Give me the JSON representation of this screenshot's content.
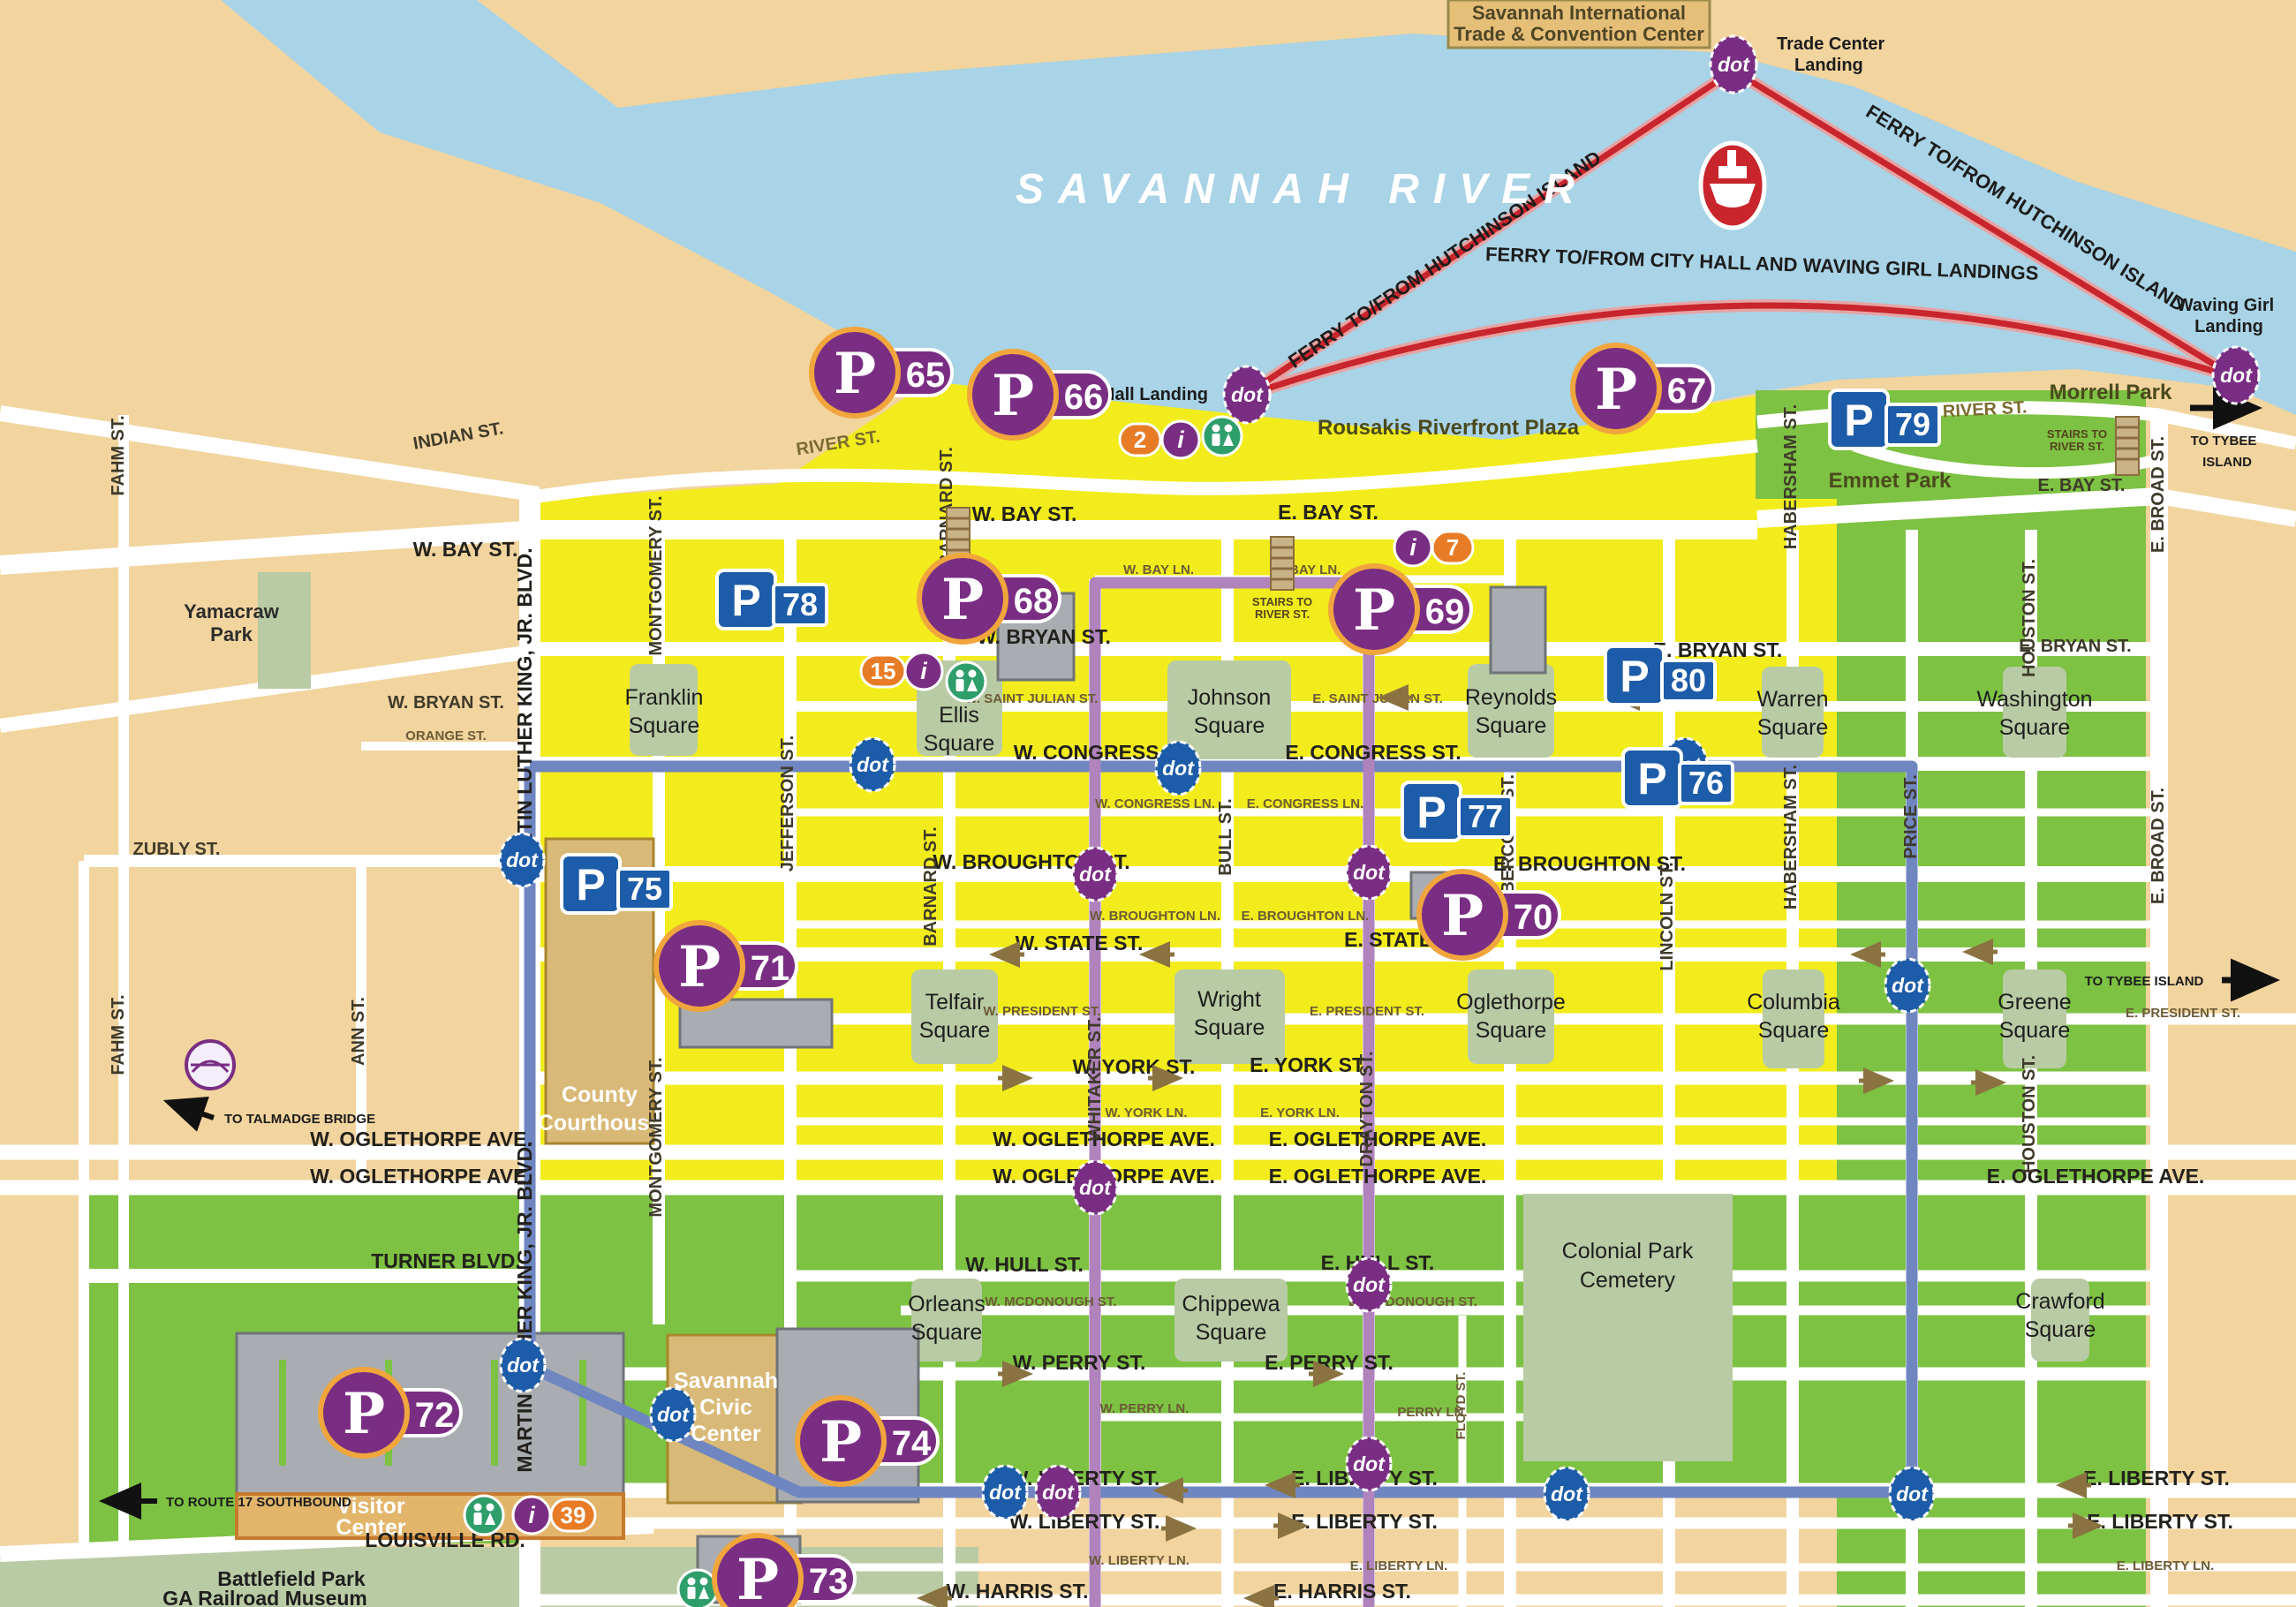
{
  "river": {
    "name": "SAVANNAH RIVER"
  },
  "ferry": {
    "hutchinson_route": "FERRY TO/FROM HUTCHINSON ISLAND",
    "cityhall_route": "FERRY TO/FROM CITY HALL AND WAVING GIRL LANDINGS",
    "trade_center_landing": [
      "Trade Center",
      "Landing"
    ],
    "city_hall_landing": "City Hall Landing",
    "waving_girl_landing": [
      "Waving Girl",
      "Landing"
    ]
  },
  "transit": {
    "dot": "dot"
  },
  "parking": {
    "letter": "P",
    "garages": {
      "p65": "65",
      "p66": "66",
      "p67": "67",
      "p68": "68",
      "p69": "69",
      "p70": "70",
      "p71": "71",
      "p72": "72",
      "p73": "73",
      "p74": "74"
    },
    "lots": {
      "p75": "75",
      "p76": "76",
      "p77": "77",
      "p78": "78",
      "p79": "79",
      "p80": "80"
    }
  },
  "info": {
    "i": "i",
    "n2": "2",
    "n7": "7",
    "n15": "15",
    "n39": "39"
  },
  "places": {
    "convention_center": [
      "Savannah International",
      "Trade & Convention Center"
    ],
    "rousakis": "Rousakis Riverfront Plaza",
    "morrell_park": "Morrell Park",
    "emmet_park": "Emmet Park",
    "yamacraw_park": [
      "Yamacraw",
      "Park"
    ],
    "county_courthouse": [
      "County",
      "Courthouse"
    ],
    "civic_center": [
      "Savannah",
      "Civic",
      "Center"
    ],
    "visitor_center": [
      "Visitor",
      "Center"
    ],
    "cemetery": [
      "Colonial Park",
      "Cemetery"
    ],
    "battlefield_park": "Battlefield Park",
    "ga_railroad_museum": "GA Railroad Museum"
  },
  "squares": {
    "franklin": [
      "Franklin",
      "Square"
    ],
    "ellis": [
      "Ellis",
      "Square"
    ],
    "johnson": [
      "Johnson",
      "Square"
    ],
    "reynolds": [
      "Reynolds",
      "Square"
    ],
    "warren": [
      "Warren",
      "Square"
    ],
    "washington": [
      "Washington",
      "Square"
    ],
    "telfair": [
      "Telfair",
      "Square"
    ],
    "wright": [
      "Wright",
      "Square"
    ],
    "oglethorpe_sq": [
      "Oglethorpe",
      "Square"
    ],
    "columbia": [
      "Columbia",
      "Square"
    ],
    "greene": [
      "Greene",
      "Square"
    ],
    "orleans": [
      "Orleans",
      "Square"
    ],
    "chippewa": [
      "Chippewa",
      "Square"
    ],
    "crawford": [
      "Crawford",
      "Square"
    ]
  },
  "streets": {
    "indian": "INDIAN ST.",
    "fahm": "FAHM ST.",
    "ann": "ANN ST.",
    "river": "RIVER ST.",
    "w_bay": "W. BAY ST.",
    "e_bay": "E. BAY ST.",
    "w_bay_ln": "W. BAY LN.",
    "e_bay_ln": "E. BAY LN.",
    "w_bryan": "W. BRYAN ST.",
    "e_bryan": "E. BRYAN ST.",
    "w_st_julian": "W. SAINT JULIAN ST.",
    "e_st_julian": "E. SAINT JULIAN ST.",
    "w_congress": "W. CONGRESS ST.",
    "e_congress": "E. CONGRESS ST.",
    "w_congress_ln": "W. CONGRESS LN.",
    "e_congress_ln": "E. CONGRESS LN.",
    "w_broughton": "W. BROUGHTON ST.",
    "e_broughton": "E. BROUGHTON ST.",
    "w_broughton_ln": "W. BROUGHTON LN.",
    "e_broughton_ln": "E. BROUGHTON LN.",
    "w_state": "W. STATE ST.",
    "e_state": "E. STATE ST.",
    "w_president": "W. PRESIDENT ST.",
    "e_president": "E. PRESIDENT ST.",
    "w_york": "W. YORK ST.",
    "e_york": "E. YORK ST.",
    "w_york_ln": "W. YORK LN.",
    "e_york_ln": "E. YORK LN.",
    "w_oglethorpe": "W. OGLETHORPE AVE.",
    "e_oglethorpe": "E. OGLETHORPE AVE.",
    "orange": "ORANGE ST.",
    "zubly": "ZUBLY ST.",
    "turner": "TURNER BLVD.",
    "louisville": "LOUISVILLE RD.",
    "w_hull": "W. HULL ST.",
    "e_hull": "E. HULL ST.",
    "w_mcdonough": "W. MCDONOUGH ST.",
    "e_mcdonough": "E. MCDONOUGH ST.",
    "w_perry": "W. PERRY ST.",
    "e_perry": "E. PERRY ST.",
    "w_perry_ln": "W. PERRY LN.",
    "perry_ln": "PERRY LN.",
    "w_liberty": "W. LIBERTY ST.",
    "e_liberty": "E. LIBERTY ST.",
    "w_liberty_ln": "W. LIBERTY LN.",
    "e_liberty_ln": "E. LIBERTY LN.",
    "w_harris": "W. HARRIS ST.",
    "e_harris": "E. HARRIS ST.",
    "mlk": "MARTIN LUTHER KING, JR. BLVD.",
    "montgomery": "MONTGOMERY ST.",
    "jefferson": "JEFFERSON ST.",
    "barnard": "BARNARD ST.",
    "whitaker": "WHITAKER ST.",
    "bull": "BULL ST.",
    "drayton": "DRAYTON ST.",
    "abercorn": "ABERCORN ST.",
    "lincoln": "LINCOLN ST.",
    "habersham": "HABERSHAM ST.",
    "price": "PRICE ST.",
    "houston": "HOUSTON ST.",
    "e_broad": "E. BROAD ST.",
    "floyd": "FLOYD ST."
  },
  "notes": {
    "to_talmadge": "TO TALMADGE BRIDGE",
    "to_route_17": "TO ROUTE 17 SOUTHBOUND",
    "to_tybee": "TO TYBEE ISLAND",
    "to_tybee_lines": [
      "TO TYBEE",
      "ISLAND"
    ],
    "stairs_lines": [
      "STAIRS TO",
      "RIVER ST."
    ]
  },
  "colors": {
    "water": "#A9D3E6",
    "land": "#F2D49E",
    "historic_yellow": "#F2EC1C",
    "district_green": "#7DC242",
    "park_sage": "#B9CBA4",
    "route_blue": "#6F86C0",
    "route_purple": "#B083BC",
    "ferry_red": "#C9252C",
    "parking_purple": "#7A2E83",
    "parking_blue": "#1C5CA8",
    "info_orange": "#E87C26",
    "restroom_green": "#2E9E6B"
  }
}
